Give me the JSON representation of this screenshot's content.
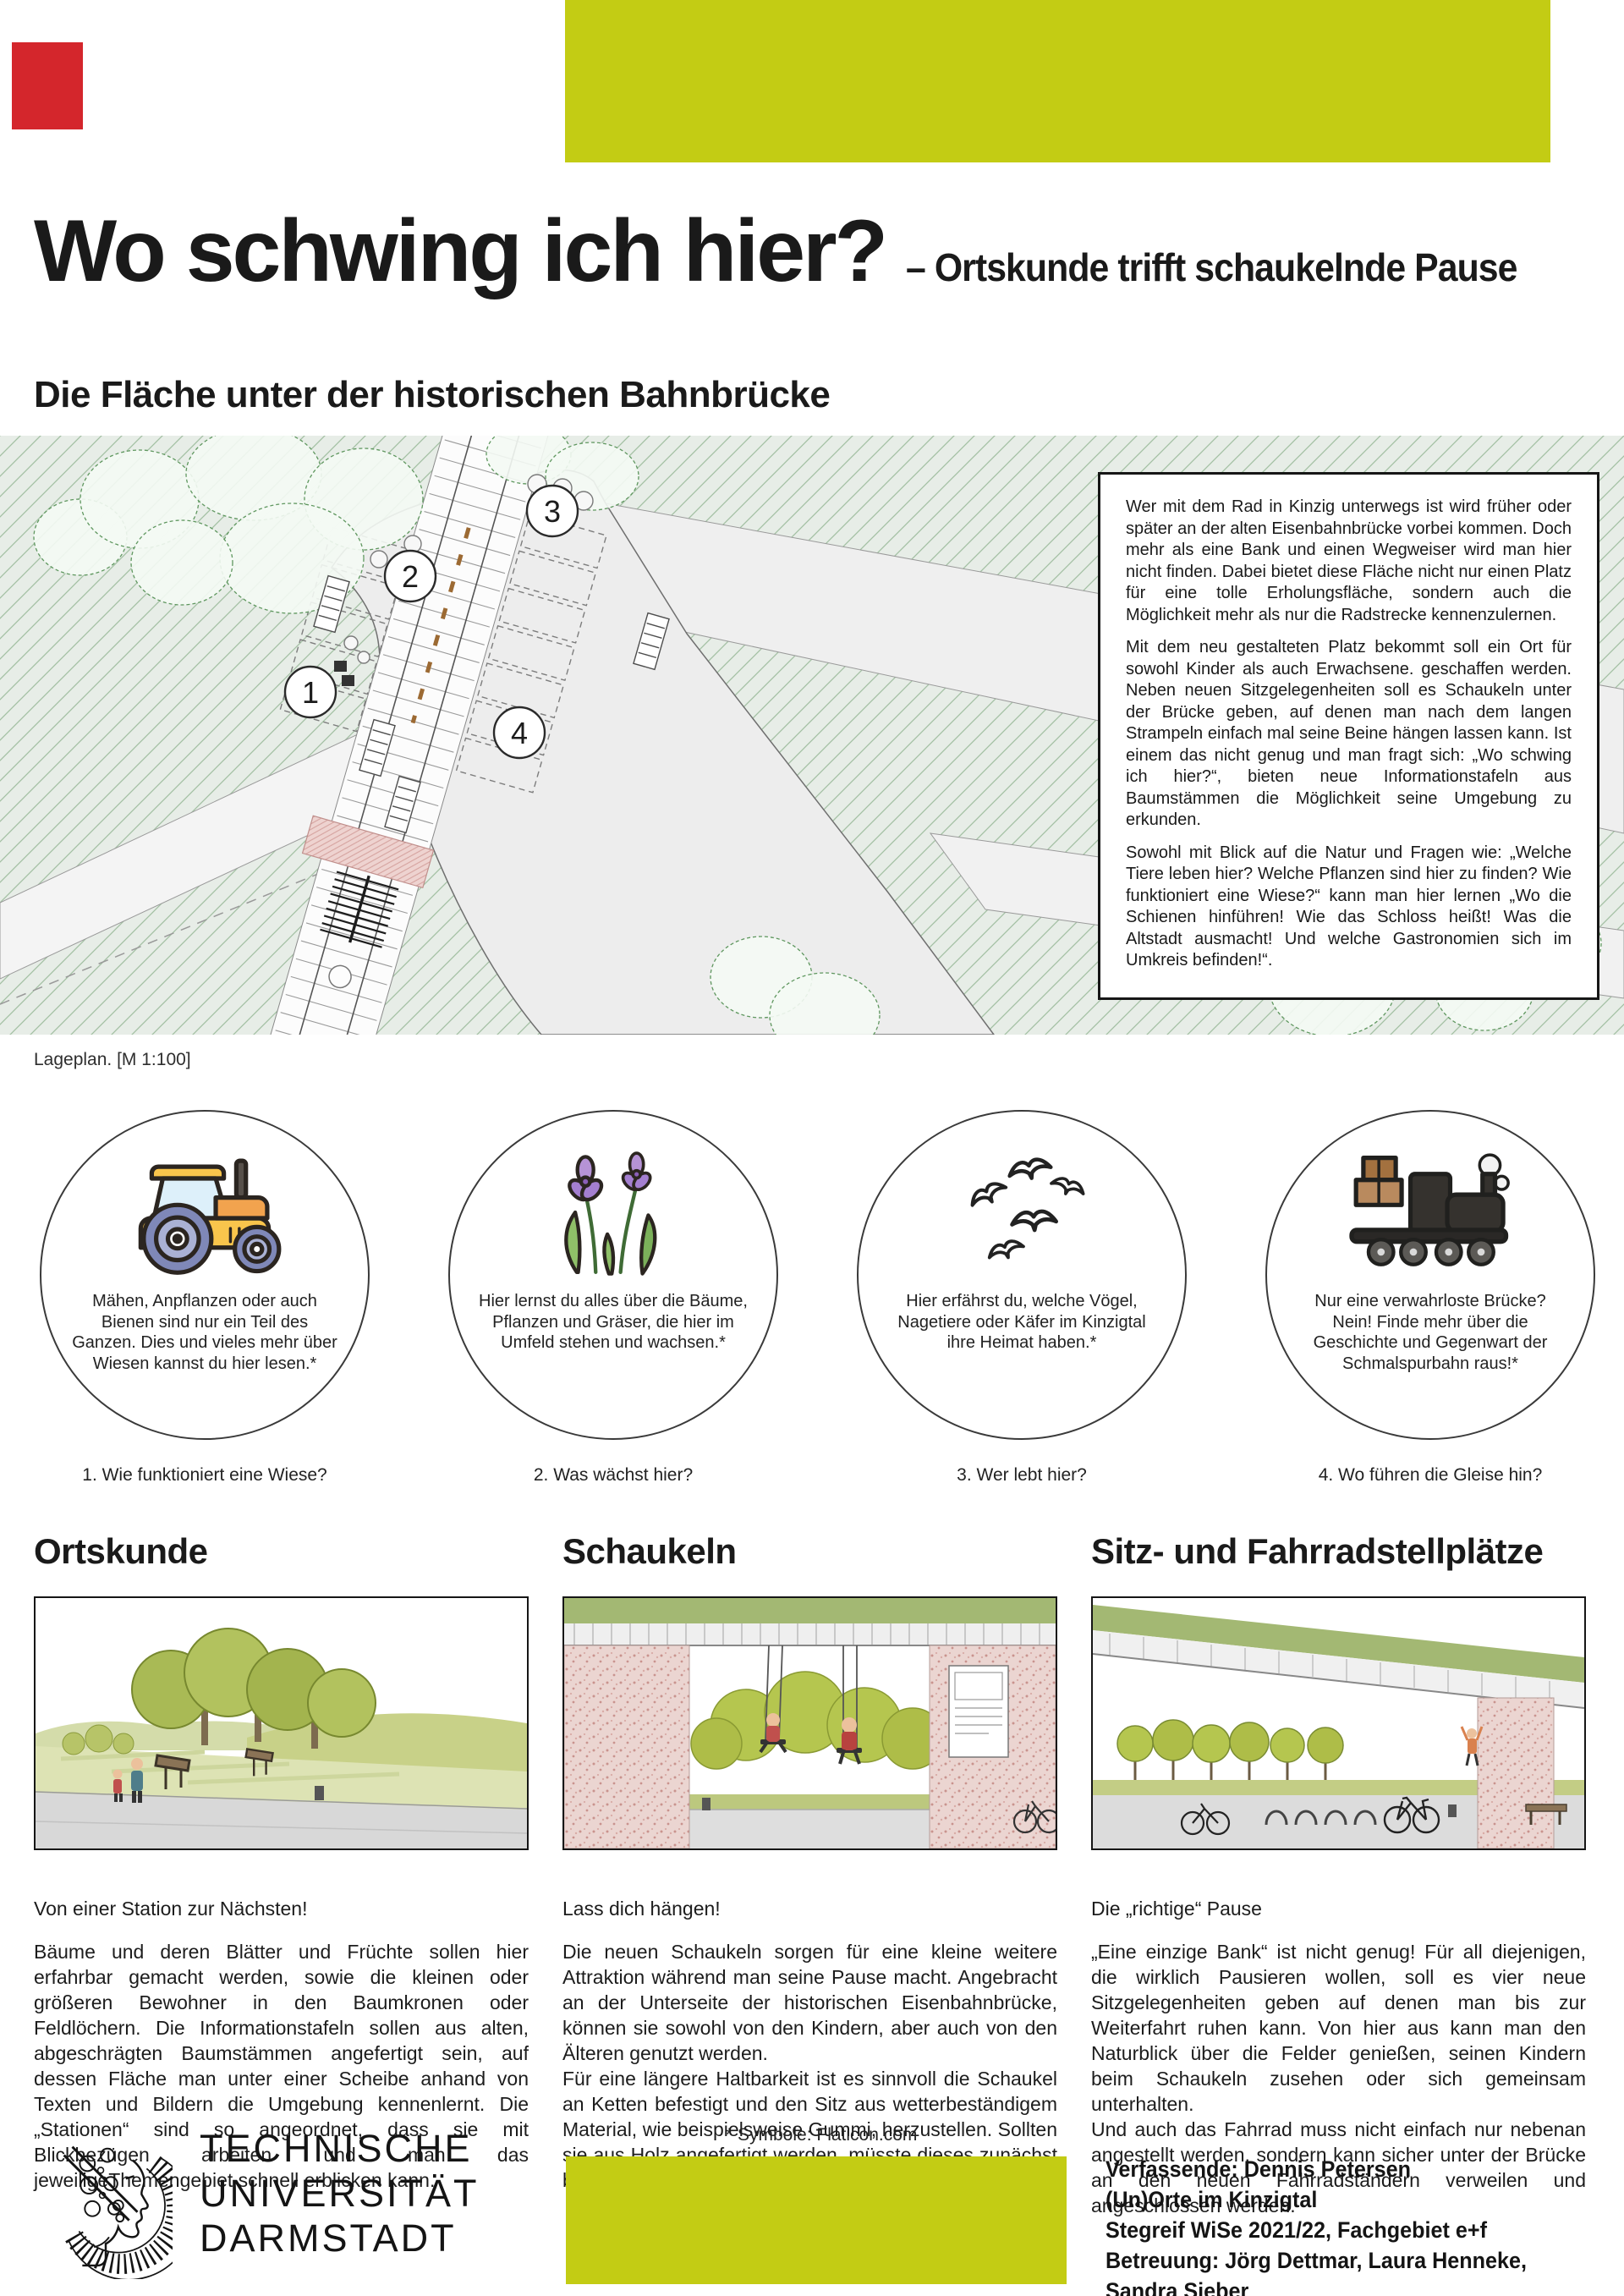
{
  "header": {
    "title": "Wo schwing ich hier?",
    "subtitle": "– Ortskunde trifft schaukelnde Pause",
    "section_title": "Die Fläche unter der historischen Bahnbrücke"
  },
  "plan": {
    "caption": "Lageplan. [M 1:100]",
    "markers": [
      "1",
      "2",
      "3",
      "4"
    ]
  },
  "intro_box": {
    "p1": "Wer mit dem Rad in Kinzig unterwegs ist wird früher oder später an der alten Eisenbahnbrücke vorbei kommen. Doch mehr als eine Bank und einen Wegweiser wird man hier nicht finden. Dabei bietet diese Fläche nicht nur einen Platz für eine tolle Erholungsfläche, sondern auch die Möglichkeit mehr als nur die Radstrecke kennenzulernen.",
    "p2": "Mit dem neu gestalteten Platz bekommt soll ein Ort für sowohl Kinder als auch Erwachsene. geschaffen werden. Neben neuen Sitzgelegenheiten soll es Schaukeln unter der Brücke geben, auf denen man nach dem langen Strampeln einfach mal seine Beine hängen lassen kann. Ist einem das nicht genug und man fragt sich: „Wo schwing ich hier?“, bieten neue Informationstafeln aus Baumstämmen die Möglichkeit seine Umgebung zu erkunden.",
    "p3": "Sowohl mit Blick auf die Natur und Fragen wie: „Welche Tiere leben hier? Welche Pflanzen sind hier zu finden? Wie funktioniert eine Wiese?“ kann man hier lernen „Wo die Schienen hinführen! Wie das Schloss heißt! Was die Altstadt ausmacht! Und welche Gastronomien sich im Umkreis befinden!“."
  },
  "stations": [
    {
      "icon": "tractor-icon",
      "text": "Mähen, Anpflanzen oder auch Bienen sind nur ein Teil des Ganzen. Dies und vieles mehr über Wiesen kannst du hier lesen.*",
      "caption": "1. Wie funktioniert eine Wiese?"
    },
    {
      "icon": "flower-icon",
      "text": "Hier lernst du alles über die Bäume, Pflanzen und Gräser, die hier im Umfeld stehen und wachsen.*",
      "caption": "2. Was wächst hier?"
    },
    {
      "icon": "birds-icon",
      "text": "Hier erfährst du, welche Vögel, Nagetiere oder Käfer im Kinzigtal ihre Heimat haben.*",
      "caption": "3. Wer lebt hier?"
    },
    {
      "icon": "train-icon",
      "text": "Nur eine verwahrloste Brücke? Nein! Finde mehr über die Geschichte und Gegenwart der Schmalspurbahn raus!*",
      "caption": "4. Wo führen die Gleise hin?"
    }
  ],
  "sections": [
    {
      "heading": "Ortskunde",
      "caption": "Von einer Station zur Nächsten!",
      "p1": "Bäume und deren Blätter und Früchte sollen hier erfahrbar gemacht werden, sowie die kleinen oder größeren Bewohner in den Baumkronen oder Feldlöchern. Die Informationstafeln sollen aus alten, abgeschrägten Baumstämmen angefertigt sein, auf dessen Fläche man unter einer Scheibe anhand von Texten und Bildern die Umgebung kennenlernt. Die „Stationen“ sind so angeordnet, dass sie mit Blickbezügen arbeiten und man das jeweiligeThemengebiet schnell erblicken kann."
    },
    {
      "heading": "Schaukeln",
      "caption": "Lass dich hängen!",
      "p1": "Die neuen Schaukeln sorgen für eine kleine weitere Attraktion während man seine Pause macht. Angebracht an der Unterseite der historischen Eisenbahnbrücke, können sie sowohl von den Kindern, aber auch von den Älteren genutzt werden.",
      "p2": "Für eine längere Haltbarkeit ist es sinnvoll die Schaukel an Ketten befestigt und den Sitz aus wetterbeständigem Material, wie beispielsweise Gummi, herzustellen. Sollten sie aus Holz angefertigt werden, müsste dieses zunächst behandelt werden, um beständiger zu sein."
    },
    {
      "heading": "Sitz- und Fahrradstellplätze",
      "caption": "Die „richtige“ Pause",
      "p1": "„Eine einzige Bank“ ist nicht genug! Für all diejenigen, die wirklich Pausieren wollen, soll es vier neue Sitzgelegenheiten geben auf denen man bis zur Weiterfahrt ruhen kann. Von hier aus kann man den Naturblick über die Felder genießen, seinen Kindern beim Schaukeln zusehen oder sich gemeinsam unterhalten.",
      "p2": "Und auch das Fahrrad muss nicht einfach nur nebenan angestellt werden, sondern kann sicher unter der Brücke an den neuen Fahrradständern verweilen und angeschlossen werden."
    }
  ],
  "footnote": "* Symbole: Flaticon.com",
  "university": {
    "line1": "TECHNISCHE",
    "line2": "UNIVERSITÄT",
    "line3": "DARMSTADT"
  },
  "credits": {
    "line1": "Verfassende: Dennis Petersen",
    "line2": "(Un)Orte im Kinzigtal",
    "line3": "Stegreif WiSe 2021/22, Fachgebiet e+f",
    "line4": "Betreuung: Jörg Dettmar, Laura Henneke, Sandra Sieber"
  },
  "colors": {
    "accent": "#c3cc14",
    "red_mark": "#d4262c",
    "plan_bg": "#e7ede7",
    "hatch_line": "#a3c0a3",
    "pink_concrete": "#eed3d0",
    "illustration_green": "#b5c64f"
  }
}
